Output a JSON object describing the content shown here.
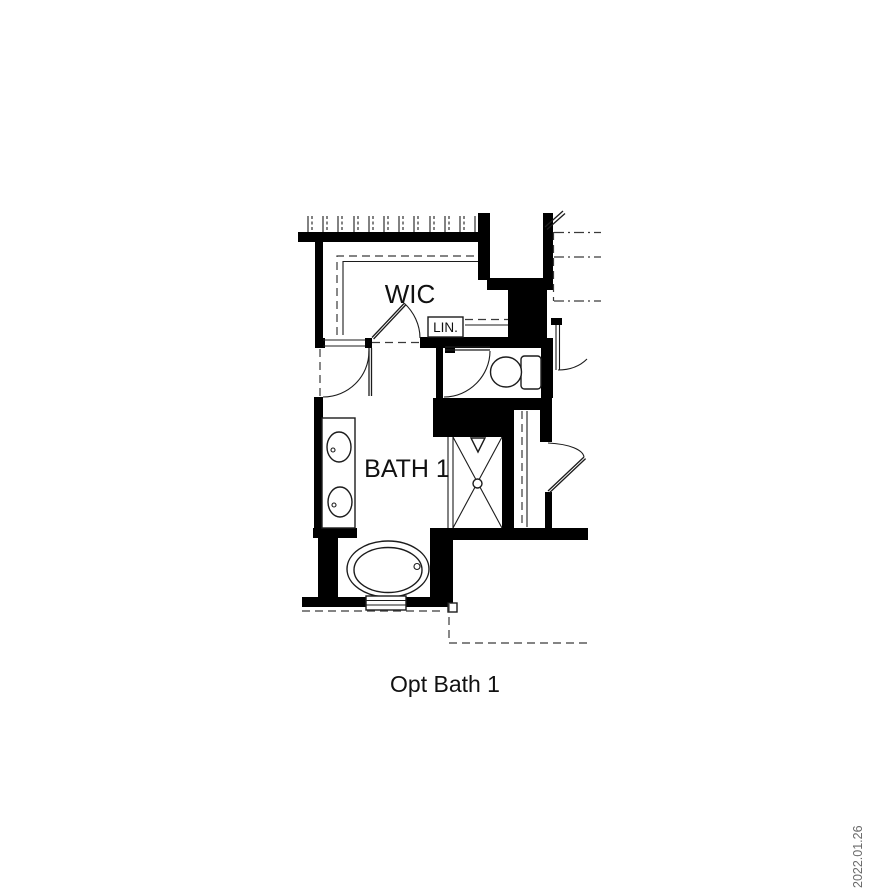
{
  "title": "Opt Bath 1 floor plan",
  "labels": {
    "wic": "WIC",
    "linen": "LIN.",
    "bath": "BATH 1"
  },
  "caption": "Opt Bath 1",
  "date_stamp": "2022.01.26",
  "colors": {
    "wall": "#000000",
    "line": "#1c1c1c",
    "dashed": "#3a3a3a",
    "date": "#6a6a6a",
    "bg": "#ffffff"
  },
  "fixtures": [
    "closet-rod-hatching",
    "wic-door",
    "linen-shelf",
    "toilet",
    "toilet-door",
    "shower",
    "shower-head",
    "vanity-double-sink",
    "bathtub",
    "tub-window",
    "entry-door",
    "closet-rail"
  ]
}
